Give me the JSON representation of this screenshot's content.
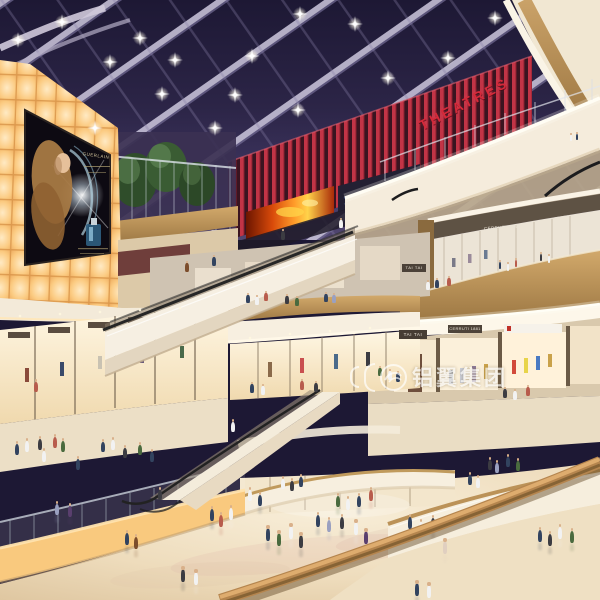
{
  "meta": {
    "description": "Architectural rendering of a multi-level shopping mall atrium at dusk with glass skylight, curved balconies, escalators and shoppers",
    "levels_visible": 5
  },
  "signs": {
    "theatres": "THEATRES",
    "tai_tai_upper": "TAI TAI",
    "tai_tai_lower": "TAI TAI",
    "cerruti_upper": "CERRUTI 1881",
    "cerruti_lower": "CERRUTI 1881",
    "billboard_brand": "GUERLAIN"
  },
  "watermark": {
    "text": "铝翼集团"
  },
  "colors": {
    "sky_top": "#1d1834",
    "sky_bottom": "#514670",
    "glow_wall": "#f9c97e",
    "theatres_red": "#cf2433",
    "cream_band": "#f5ecdc",
    "wood": "#b5854e",
    "fire_screen": "#ff9c2a"
  },
  "ceiling_lights": [
    [
      18,
      40
    ],
    [
      62,
      22
    ],
    [
      110,
      62
    ],
    [
      95,
      128
    ],
    [
      162,
      94
    ],
    [
      175,
      60
    ],
    [
      215,
      128
    ],
    [
      252,
      56
    ],
    [
      298,
      110
    ],
    [
      355,
      24
    ],
    [
      388,
      78
    ],
    [
      300,
      14
    ],
    [
      448,
      58
    ],
    [
      495,
      18
    ],
    [
      140,
      38
    ],
    [
      235,
      95
    ]
  ],
  "person_colors": [
    "#f2f2f2",
    "#32435f",
    "#733135",
    "#3c3c42",
    "#7c4d2c",
    "#4a6a3e",
    "#9aa0c0",
    "#e0cfc0",
    "#5a3f6e",
    "#2f6b5c",
    "#b85c4c",
    "#c9b24a"
  ],
  "people": [
    [
      571,
      141,
      6,
      0
    ],
    [
      577,
      140,
      6,
      1
    ],
    [
      500,
      269,
      7,
      1
    ],
    [
      508,
      271,
      7,
      0
    ],
    [
      516,
      267,
      7,
      10
    ],
    [
      541,
      261,
      7,
      3
    ],
    [
      549,
      263,
      7,
      0
    ],
    [
      428,
      290,
      8,
      0
    ],
    [
      437,
      288,
      8,
      1
    ],
    [
      449,
      286,
      8,
      10
    ],
    [
      248,
      303,
      8,
      1
    ],
    [
      257,
      305,
      8,
      0
    ],
    [
      266,
      301,
      8,
      10
    ],
    [
      287,
      304,
      8,
      3
    ],
    [
      297,
      306,
      8,
      5
    ],
    [
      326,
      302,
      8,
      1
    ],
    [
      334,
      303,
      8,
      6
    ],
    [
      187,
      272,
      9,
      4
    ],
    [
      214,
      266,
      9,
      1
    ],
    [
      283,
      240,
      9,
      3
    ],
    [
      341,
      228,
      8,
      0
    ],
    [
      390,
      380,
      9,
      0
    ],
    [
      398,
      382,
      9,
      1
    ],
    [
      380,
      376,
      8,
      5
    ],
    [
      505,
      398,
      9,
      3
    ],
    [
      515,
      400,
      9,
      0
    ],
    [
      528,
      396,
      9,
      10
    ],
    [
      252,
      393,
      9,
      1
    ],
    [
      263,
      395,
      9,
      0
    ],
    [
      302,
      390,
      9,
      10
    ],
    [
      316,
      392,
      9,
      3
    ],
    [
      36,
      392,
      10,
      10
    ],
    [
      103,
      452,
      10,
      1
    ],
    [
      113,
      450,
      10,
      0
    ],
    [
      125,
      458,
      10,
      3
    ],
    [
      140,
      455,
      10,
      5
    ],
    [
      152,
      462,
      10,
      1
    ],
    [
      17,
      455,
      11,
      1
    ],
    [
      27,
      452,
      11,
      0
    ],
    [
      40,
      450,
      11,
      3
    ],
    [
      55,
      448,
      11,
      10
    ],
    [
      63,
      452,
      11,
      5
    ],
    [
      44,
      462,
      11,
      0
    ],
    [
      78,
      470,
      11,
      1
    ],
    [
      57,
      515,
      11,
      6
    ],
    [
      70,
      517,
      11,
      8
    ],
    [
      470,
      485,
      10,
      1
    ],
    [
      478,
      488,
      10,
      0
    ],
    [
      490,
      470,
      10,
      3
    ],
    [
      497,
      473,
      10,
      6
    ],
    [
      508,
      467,
      10,
      1
    ],
    [
      518,
      471,
      10,
      5
    ],
    [
      445,
      554,
      13,
      7
    ],
    [
      540,
      542,
      12,
      1
    ],
    [
      550,
      546,
      12,
      3
    ],
    [
      560,
      539,
      12,
      0
    ],
    [
      572,
      543,
      12,
      5
    ],
    [
      417,
      596,
      13,
      1
    ],
    [
      429,
      598,
      13,
      0
    ],
    [
      183,
      582,
      13,
      3
    ],
    [
      196,
      585,
      13,
      0
    ],
    [
      212,
      521,
      12,
      1
    ],
    [
      221,
      527,
      12,
      10
    ],
    [
      231,
      520,
      12,
      0
    ],
    [
      268,
      541,
      13,
      1
    ],
    [
      279,
      546,
      13,
      5
    ],
    [
      291,
      539,
      13,
      0
    ],
    [
      301,
      548,
      13,
      3
    ],
    [
      318,
      527,
      12,
      1
    ],
    [
      329,
      532,
      12,
      6
    ],
    [
      342,
      529,
      12,
      3
    ],
    [
      356,
      535,
      13,
      0
    ],
    [
      366,
      544,
      13,
      8
    ],
    [
      410,
      529,
      12,
      1
    ],
    [
      421,
      534,
      12,
      0
    ],
    [
      433,
      530,
      12,
      3
    ],
    [
      127,
      545,
      12,
      1
    ],
    [
      136,
      549,
      12,
      4
    ],
    [
      250,
      501,
      11,
      0
    ],
    [
      260,
      506,
      11,
      1
    ],
    [
      283,
      489,
      10,
      0
    ],
    [
      292,
      491,
      10,
      3
    ],
    [
      301,
      487,
      10,
      1
    ],
    [
      338,
      507,
      11,
      5
    ],
    [
      348,
      510,
      11,
      0
    ],
    [
      359,
      507,
      11,
      1
    ],
    [
      371,
      501,
      11,
      10
    ],
    [
      233,
      432,
      10,
      0
    ],
    [
      160,
      500,
      10,
      3
    ]
  ]
}
